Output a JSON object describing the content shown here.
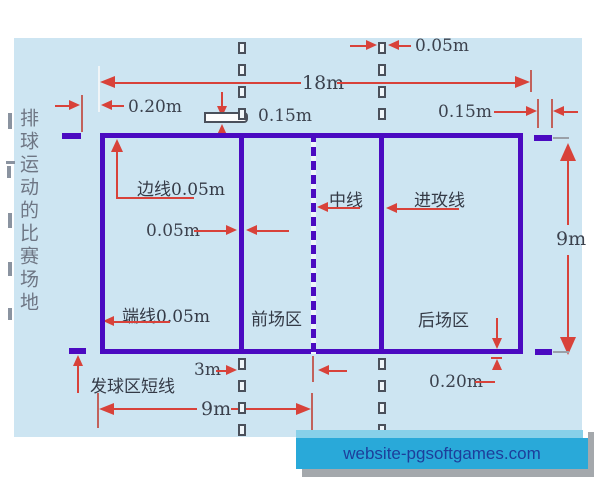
{
  "diagram_title_vertical": "排球运动的比赛场地",
  "watermark_banner": {
    "text": "website-pgsoftgames.com"
  },
  "court_labels": {
    "side_line": "边线0.05m",
    "attack_line_width": "0.05m",
    "center_line": "中线",
    "attack_line": "进攻线",
    "end_line": "端线0.05m",
    "front_zone": "前场区",
    "back_zone": "后场区",
    "service_zone_short_line": "发球区短线"
  },
  "dimension_labels": {
    "court_length": "18m",
    "court_width": "9m",
    "half_court_length": "9m",
    "attack_line_distance": "3m",
    "short_line_setback": "0.20m",
    "extension_dash_length": "0.15m",
    "short_line_length": "0.15m",
    "extension_dash_width": "0.05m",
    "extension_dash_gap": "0.20m"
  },
  "colors": {
    "diagram_background": "#cde5f2",
    "court_line": "#4b0ac1",
    "dimension_line": "#d8423a",
    "label_text": "#343a46",
    "vertical_title_text": "#6e7684",
    "banner_background": "#29a9d9",
    "banner_text": "#1d3e9b"
  }
}
